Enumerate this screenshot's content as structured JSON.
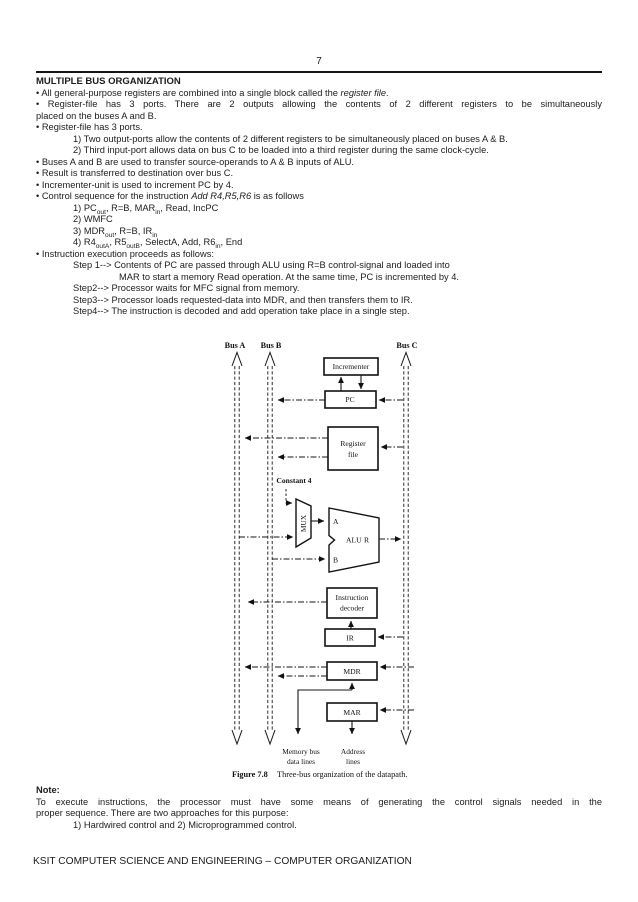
{
  "page": {
    "number": "7",
    "footer": "KSIT COMPUTER SCIENCE AND ENGINEERING – COMPUTER ORGANIZATION"
  },
  "content": {
    "title": "MULTIPLE BUS ORGANIZATION",
    "b1_pre": "• All general-purpose registers are combined into a single block called the ",
    "b1_italic": "register file",
    "b1_post": ".",
    "b2_line1": "• Register-file has 3 ports. There are 2 outputs allowing the contents of 2 different registers to be simultaneously",
    "b2_line2": "placed on the buses A and B.",
    "b3": "• Register-file has 3 ports.",
    "b3_sub1": "1) Two output-ports allow the contents of 2 different registers to be simultaneously placed on buses A & B.",
    "b3_sub2": "2) Third input-port allows data on bus C to be loaded into a third register during the same clock-cycle.",
    "b4": "• Buses A and B are used to transfer source-operands to A & B inputs of ALU.",
    "b5": "• Result is transferred to destination over bus C.",
    "b6": "• Incrementer-unit is used to increment PC by 4.",
    "b7_pre": "• Control sequence for the instruction ",
    "b7_italic": "Add R4,R5,R6",
    "b7_post": " is as follows",
    "seq1_parts": [
      "1) PC",
      "out",
      ", R=B, MAR",
      "in",
      ", Read, IncPC"
    ],
    "seq2": "2) WMFC",
    "seq3_parts": [
      "3) MDR",
      "out",
      ", R=B, IR",
      "in"
    ],
    "seq4_parts": [
      "4) R4",
      "outA",
      ", R5",
      "outB",
      ", SelectA, Add, R6",
      "in",
      ", End"
    ],
    "b8": "• Instruction execution proceeds as follows:",
    "step1_line1": "Step 1--> Contents of PC are passed through ALU using R=B control-signal and loaded into",
    "step1_line2": "MAR to start a memory Read operation. At the same time, PC is incremented by 4.",
    "step2": "Step2--> Processor waits for MFC signal from memory.",
    "step3": "Step3--> Processor loads requested-data into MDR, and then transfers them to IR.",
    "step4": "Step4--> The instruction is decoded and add operation take place in a single step."
  },
  "note": {
    "label": "Note:",
    "body_line1": "To execute instructions, the processor must have some means of generating the control signals needed in the",
    "body_line2": "proper sequence. There are two approaches for this purpose:",
    "item": "1)  Hardwired control and 2) Microprogrammed control."
  },
  "figure": {
    "bus_a": "Bus A",
    "bus_b": "Bus B",
    "bus_c": "Bus C",
    "incrementer": "Incrementer",
    "pc": "PC",
    "register_file_line1": "Register",
    "register_file_line2": "file",
    "constant4": "Constant 4",
    "mux": "MUX",
    "alu": "ALU",
    "alu_in_a": "A",
    "alu_in_b": "B",
    "alu_out_r": "R",
    "decoder_line1": "Instruction",
    "decoder_line2": "decoder",
    "ir": "IR",
    "mdr": "MDR",
    "mar": "MAR",
    "membus_line1": "Memory bus",
    "membus_line2": "data lines",
    "address_line1": "Address",
    "address_line2": "lines",
    "caption_label": "Figure 7.8",
    "caption_text": "Three-bus organization of the datapath."
  }
}
